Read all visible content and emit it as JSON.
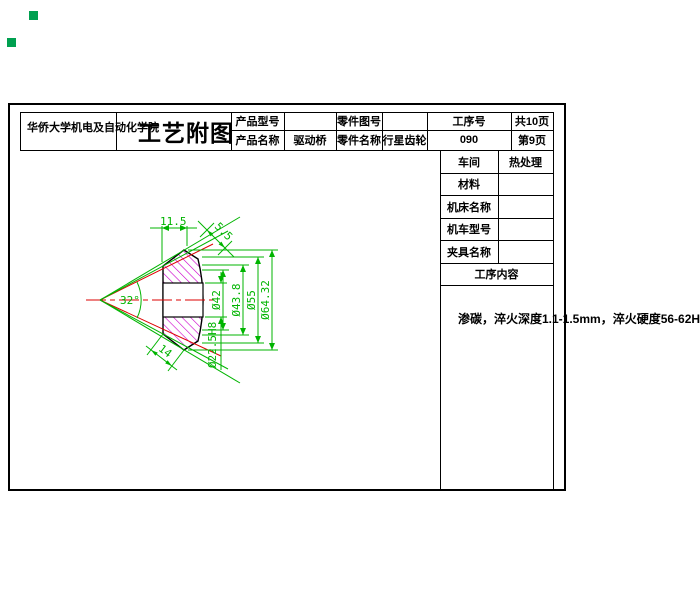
{
  "grips": {
    "color": "#00a050"
  },
  "header": {
    "university": "华侨大学机电及自动化学院",
    "title": "工艺附图",
    "product_model_label": "产品型号",
    "product_model_value": "",
    "part_drawing_no_label": "零件图号",
    "part_drawing_no_value": "",
    "process_no_label": "工序号",
    "total_pages": "共10页",
    "product_name_label": "产品名称",
    "product_name_value": "驱动桥",
    "part_name_label": "零件名称",
    "part_name_value": "行星齿轮",
    "process_no_value": "090",
    "page_no": "第9页"
  },
  "info_table": {
    "rows": [
      {
        "label": "车间",
        "value": "热处理"
      },
      {
        "label": "材料",
        "value": ""
      },
      {
        "label": "机床名称",
        "value": ""
      },
      {
        "label": "机车型号",
        "value": ""
      },
      {
        "label": "夹具名称",
        "value": ""
      }
    ],
    "section_header": "工序内容"
  },
  "note": "渗碳，淬火深度1.1-1.5mm，淬火硬度56-62HRC",
  "drawing": {
    "dims": {
      "top_width": "11.5",
      "tooth_depth": "5.5",
      "cone_angle": "32°",
      "back_width": "14",
      "d42": "Ø42",
      "d438": "Ø43.8",
      "d55": "Ø55",
      "d6432": "Ø64.32",
      "bore": "Ø22.5H8"
    },
    "colors": {
      "dimension": "#00b400",
      "centerline": "#dd0000",
      "hatch": "#cc00cc",
      "outline": "#000000",
      "grip": "#00a050"
    }
  }
}
